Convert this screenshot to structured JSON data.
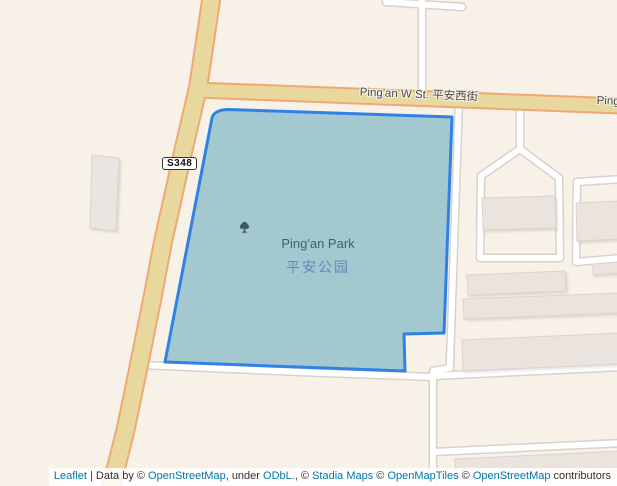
{
  "map": {
    "name": "leaflet-map-pingan-park",
    "background_color": "#f8f1e7"
  },
  "roads": {
    "shield_label": "S348",
    "main_street_label": "Ping'an W St. 平安西街",
    "main_road_fill": "#e8d89d",
    "main_road_casing": "#efa873",
    "minor_road_fill": "#ffffff",
    "minor_road_casing": "#d7d2cb"
  },
  "park": {
    "name_en": "Ping'an Park",
    "name_zh": "平安公园",
    "fill_color": "#a4c8d0",
    "outline_color": "#2e82e4",
    "icon": "tree-icon"
  },
  "buildings": {
    "fill_color": "#ebe3de"
  },
  "attribution": {
    "link_color": "#0078A8",
    "segments": [
      {
        "text": "Leaflet",
        "link": true
      },
      {
        "text": " | Data by © ",
        "link": false
      },
      {
        "text": "OpenStreetMap",
        "link": true
      },
      {
        "text": ", under ",
        "link": false
      },
      {
        "text": "ODbL.",
        "link": true
      },
      {
        "text": ", © ",
        "link": false
      },
      {
        "text": "Stadia Maps",
        "link": true
      },
      {
        "text": " © ",
        "link": false
      },
      {
        "text": "OpenMapTiles",
        "link": true
      },
      {
        "text": " © ",
        "link": false
      },
      {
        "text": "OpenStreetMap",
        "link": true
      },
      {
        "text": " contributors",
        "link": false
      }
    ]
  }
}
